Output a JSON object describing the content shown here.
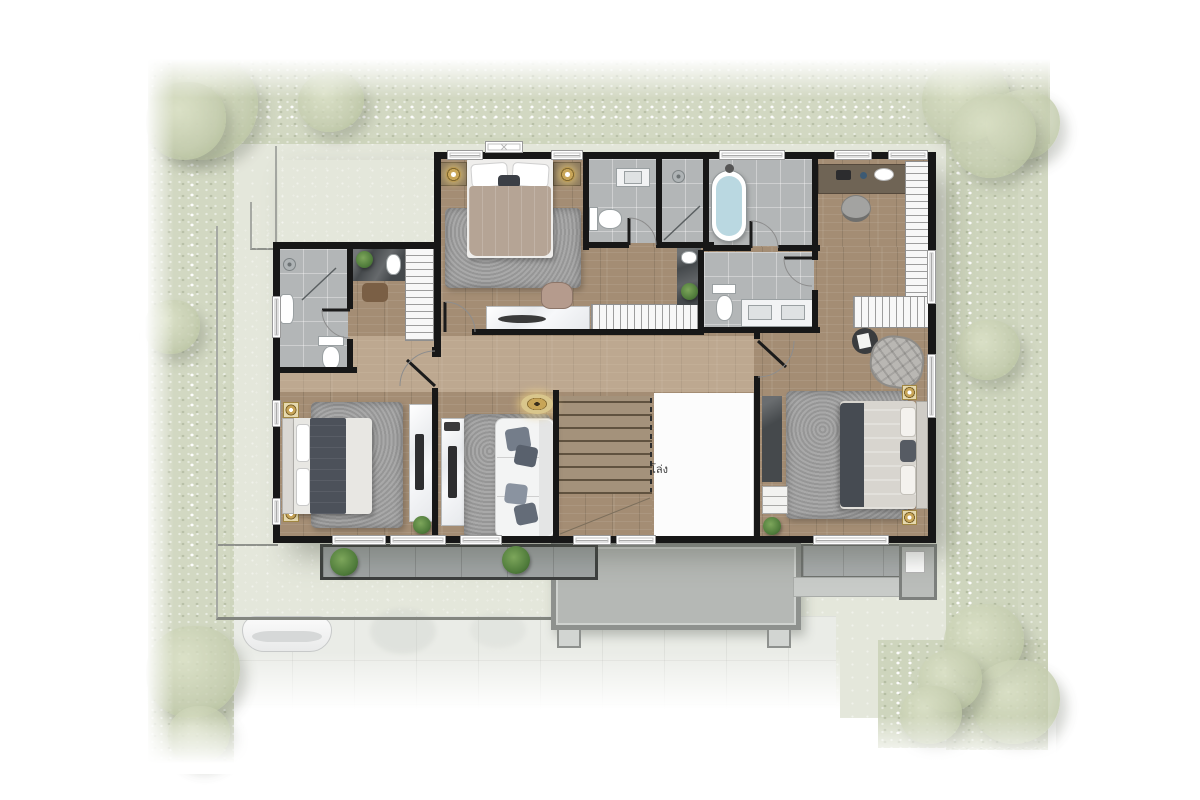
{
  "meta": {
    "type": "floor-plan",
    "view": "top-down-render",
    "floor": "upper-floor"
  },
  "labels": {
    "void": "โล่ง"
  },
  "colors": {
    "wall": "#171717",
    "wood": "#a48d74",
    "ground": "#e4e7db",
    "hedge": "#cbd2b8",
    "tree": "#c5cdaf",
    "flower": "#ffffff",
    "driveway": "#eaece7",
    "roof": "#c2c5c2",
    "porch": "#b5b8b5",
    "porch_frame": "#8e918e",
    "balcony": "#9fa4a4",
    "balcony_frame": "#3c3f3e",
    "tile": "#b3b6b7",
    "rug": "#a1a1a1",
    "gold": "#c8a557",
    "water": "#bad8e1",
    "stair": "#a4927b",
    "stair_line": "#60523f",
    "counter_dark": "#45494c",
    "duvet_dark": "#4c515a",
    "duvet_taupe": "#b5a495",
    "duvet_light": "#d8d5cf",
    "sofa": "#f3f4f4",
    "pillow_gray": "#747d8a",
    "plant": "#4e7a3a",
    "plant_light": "#7da65b"
  },
  "rooms": [
    {
      "id": "master-bedroom"
    },
    {
      "id": "dressing-area"
    },
    {
      "id": "ensuite-bathroom"
    },
    {
      "id": "wc-shower-bathroom"
    },
    {
      "id": "bathtub-room"
    },
    {
      "id": "double-vanity-bathroom"
    },
    {
      "id": "study-corner"
    },
    {
      "id": "bedroom-2"
    },
    {
      "id": "family-sitting-area"
    },
    {
      "id": "staircase"
    },
    {
      "id": "void-open-below"
    },
    {
      "id": "bedroom-3"
    },
    {
      "id": "balcony-left"
    },
    {
      "id": "balcony-right"
    },
    {
      "id": "porch-roof"
    },
    {
      "id": "driveway"
    }
  ],
  "furniture": [
    "double-bed",
    "single-bed",
    "king-bed",
    "sofa",
    "lounge-chair",
    "desk",
    "office-chair",
    "wardrobe",
    "walk-in-closet",
    "vanity-table",
    "makeup-stool",
    "freestanding-bathtub",
    "toilet",
    "washbasin",
    "double-sink-counter",
    "shower",
    "tv-panel",
    "side-table",
    "floor-lamp",
    "table-lamp",
    "potted-plant",
    "area-rug",
    "stairs",
    "car"
  ]
}
